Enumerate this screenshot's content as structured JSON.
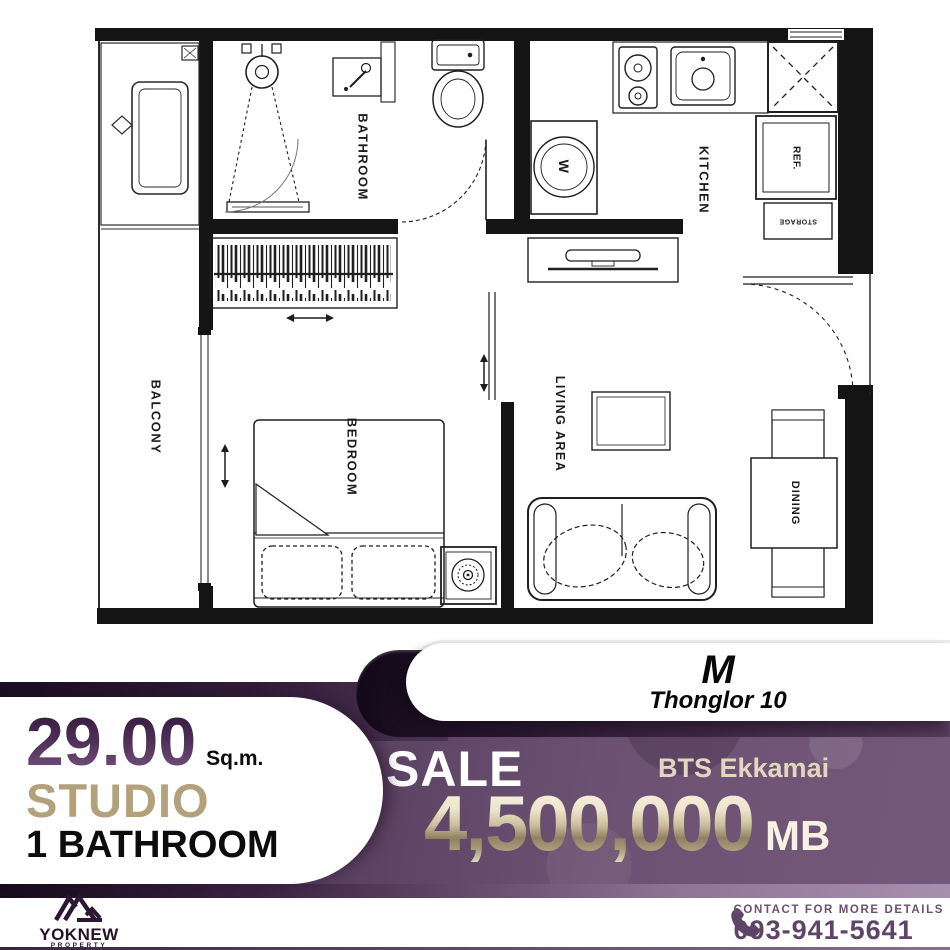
{
  "project": {
    "name": "M",
    "location": "Thonglor 10"
  },
  "listing": {
    "area_value": "29.00",
    "area_unit": "Sq.m.",
    "unit_type": "STUDIO",
    "bathrooms": "1 BATHROOM",
    "deal_type": "SALE",
    "station": "BTS Ekkamai",
    "price": "4,500,000",
    "currency": "MB"
  },
  "floor_plan": {
    "rooms": {
      "balcony": "BALCONY",
      "bathroom": "BATHROOM",
      "kitchen": "KITCHEN",
      "bedroom": "BEDROOM",
      "living_area": "LIVING AREA",
      "dining": "DINING"
    },
    "fixtures": {
      "washing_machine": "W",
      "refrigerator": "REF.",
      "storage": "STORAGE"
    }
  },
  "footer": {
    "brand": "YOKNEW",
    "brand_sub": "PROPERTY",
    "contact_label": "CONTACT FOR MORE DETAILS",
    "phone": "093-941-5641"
  },
  "colors": {
    "deep_purple": "#24132b",
    "ribbon_purple": "#34203b",
    "panel_purple": "#6b5172",
    "champagne": "#d9cbaf",
    "tan": "#b3a17c",
    "contact_purple": "#5e4568"
  }
}
